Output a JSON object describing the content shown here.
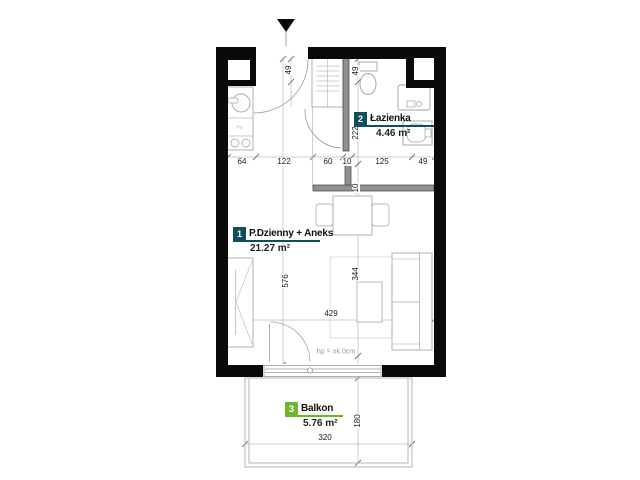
{
  "plan": {
    "entrance": {
      "arrow": "entrance-arrow"
    },
    "rooms": {
      "living": {
        "num": "1",
        "name": "P.Dzienny + Aneks",
        "area": "21.27 m²"
      },
      "bath": {
        "num": "2",
        "name": "Łazienka",
        "area": "4.46 m²"
      },
      "balcony": {
        "num": "3",
        "name": "Balkon",
        "area": "5.76 m²"
      }
    },
    "dimensions": {
      "top_chain": [
        "64",
        "122",
        "60",
        "10",
        "125",
        "49"
      ],
      "entry_depth": "49",
      "bath_side": "49",
      "bath_depth": "222",
      "partition_thk": "10",
      "living_height": "576",
      "sofa_wall": "344",
      "living_width": "429",
      "balcony_width": "320",
      "balcony_depth": "180"
    },
    "notes": {
      "parapet": "hp = ok.0cm"
    },
    "kitchen": {
      "hob_mark": "2"
    },
    "colors": {
      "teal": "#0f4e5d",
      "green": "#70b62c",
      "wall": "#0a0a0a"
    }
  }
}
